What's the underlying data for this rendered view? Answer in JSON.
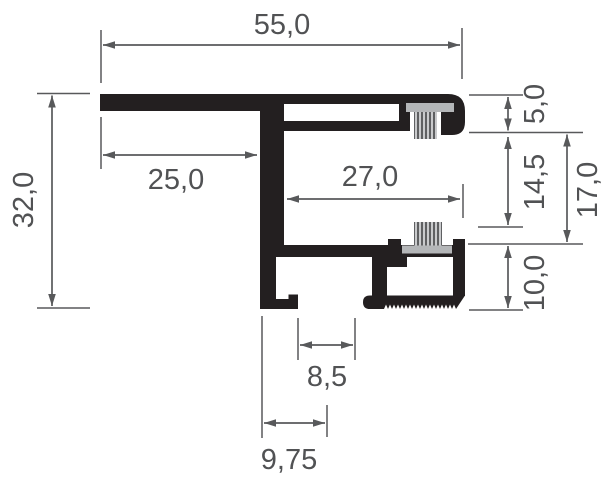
{
  "drawing": {
    "type": "technical-cross-section",
    "subject": "aluminium-frame-profile-with-brush-seals",
    "labels": {
      "overall_width": "55,0",
      "overall_height": "32,0",
      "left_flange_offset": "25,0",
      "chamber_inner_width": "27,0",
      "top_section_height": "5,0",
      "brush_gap_height": "14,5",
      "side_height": "17,0",
      "bottom_box_height": "10,0",
      "foot_gap_width": "8,5",
      "foot_center_offset": "9,75"
    },
    "colors": {
      "background": "#ffffff",
      "profile": "#231f20",
      "dimension_lines": "#58595b",
      "dimension_text": "#515254",
      "brush_holder": "#b4b6b8",
      "brush_bristle_light": "#c9cacc",
      "brush_bristle_dark": "#5f6062"
    }
  }
}
